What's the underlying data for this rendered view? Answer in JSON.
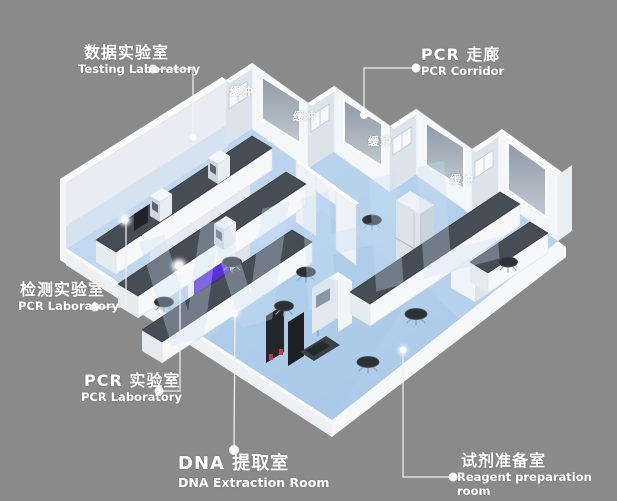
{
  "watermark": "WHL",
  "labels": {
    "testing": {
      "zh": "数据实验室",
      "en": "Testing Laboratory"
    },
    "pcr_corridor": {
      "zh": "PCR 走廊",
      "en": "PCR Corridor"
    },
    "detection": {
      "zh": "检测实验室",
      "en": "PCR Laboratory"
    },
    "pcr_lab": {
      "zh": "PCR 实验室",
      "en": "PCR Laboratory"
    },
    "dna": {
      "zh": "DNA 提取室",
      "en": "DNA Extraction Room"
    },
    "reagent": {
      "zh": "试剂准备室",
      "en": "Reagent preparation room"
    }
  },
  "buffer_labels": [
    "缓冲",
    "缓冲",
    "缓冲",
    "缓冲"
  ],
  "colors": {
    "background": "#8a8a8a",
    "floor": "#b3cfeb",
    "wall": "#f4f7fa",
    "accent_purple": "#5a2fd6",
    "bench_top": "#474d55",
    "label_text": "#ffffff",
    "watermark": "#c9e0f5"
  }
}
